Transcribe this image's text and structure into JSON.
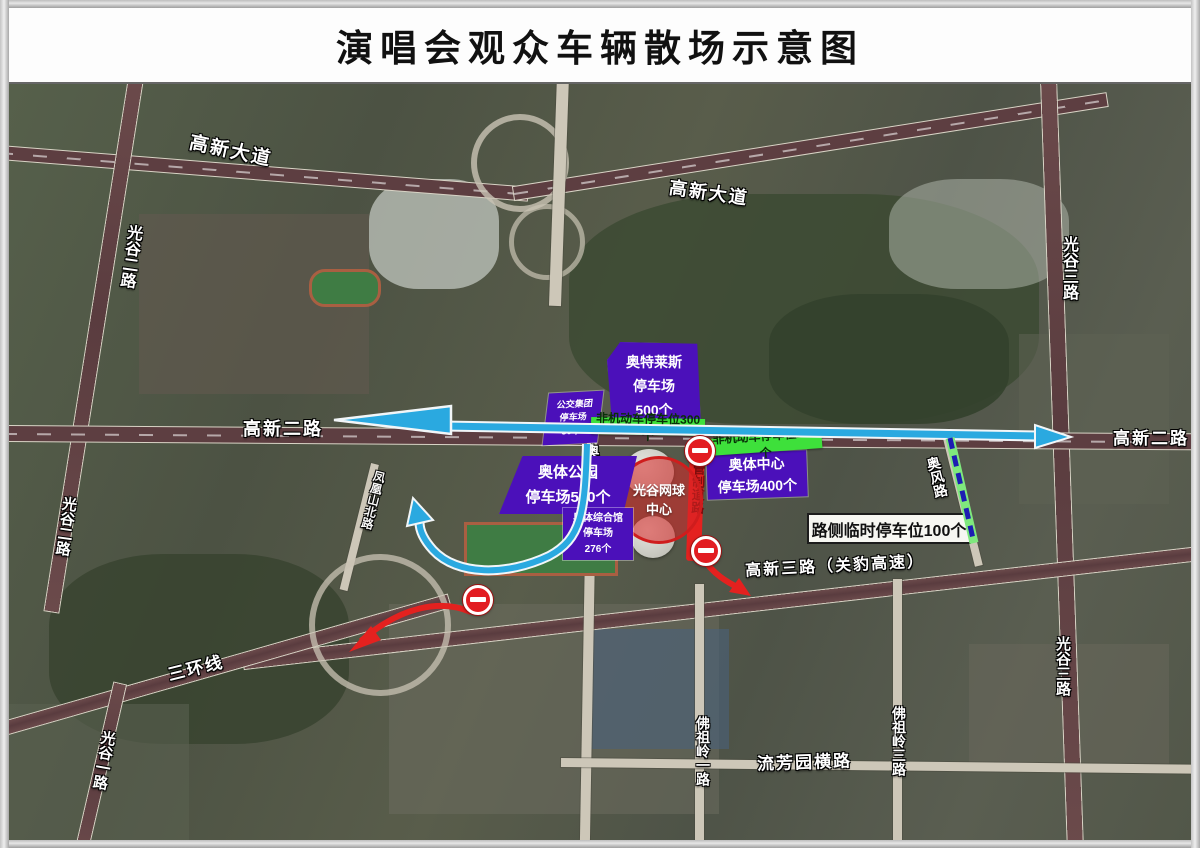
{
  "title": "演唱会观众车辆散场示意图",
  "map": {
    "roads": {
      "gaoxin_avenue_west": "高新大道",
      "gaoxin_avenue_east": "高新大道",
      "guanggu_2nd_top": "光谷二路",
      "guanggu_2nd_mid": "光谷二路",
      "guanggu_3rd_top": "光谷三路",
      "guanggu_3rd_bottom": "光谷三路",
      "gaoxin_2nd_west": "高新二路",
      "gaoxin_2nd_east": "高新二路",
      "gaoxin_3rd": "高新三路（关豹高速）",
      "third_ring": "三环线",
      "aoti_park_no3": "奥体公园3号路",
      "controlled_road": "管制道路",
      "aofeng_road": "奥风路",
      "guanggu_1st": "光谷一路",
      "fozuling_1st": "佛祖岭一路",
      "liufangyuan_heng": "流芳园横路",
      "fozuling_3rd": "佛祖岭三路",
      "fenghuangshan_north": "凤凰山北路"
    },
    "parking": {
      "outlets": {
        "l1": "奥特莱斯",
        "l2": "停车场",
        "l3": "500个"
      },
      "bus_group": {
        "l1": "公交集团",
        "l2": "停车场",
        "l3": "80个"
      },
      "aoti_center": {
        "l1": "奥体中心",
        "l2": "停车场400个"
      },
      "aoti_park": {
        "l1": "奥体公园",
        "l2": "停车场550个"
      },
      "aoti_gym": {
        "l1": "奥体综合馆",
        "l2": "停车场",
        "l3": "276个"
      },
      "bike_300": "非机动车停车位300个",
      "bike_200": "非机动车停车位200个",
      "roadside_100": "路侧临时停车位100个"
    },
    "venue": {
      "l1": "光谷网球",
      "l2": "中心"
    },
    "colors": {
      "parking_purple": "#4b10ba",
      "bike_green": "#3ee03b",
      "route_blue": "#2aa9e0",
      "control_red": "#e4211f",
      "roadside_dash_blue": "#1d1db2"
    }
  }
}
